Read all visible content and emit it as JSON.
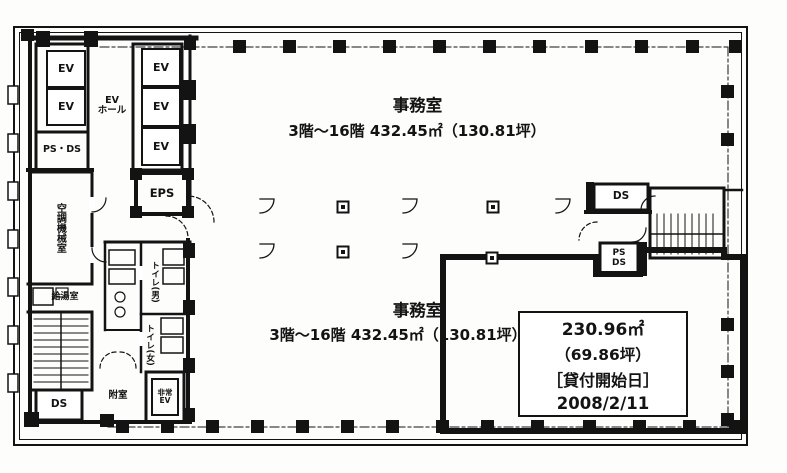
{
  "plan_type": "office-floor-plan",
  "colors": {
    "ink": "#131313",
    "paper": "#fdfdfc"
  },
  "labels": {
    "ev": "EV",
    "ev_hall": {
      "line1": "EV",
      "line2": "ホール"
    },
    "ps_ds_left": "PS・DS",
    "eps": "EPS",
    "hvac_room": "空調機械室",
    "kitchenette": "給湯室",
    "toilet_men": "トイレ(男)",
    "toilet_women": "トイレ(女)",
    "ds_lower_left": "DS",
    "vestibule": "附室",
    "emergency_ev": {
      "line1": "非常",
      "line2": "EV"
    },
    "ds_right": "DS",
    "ps_ds_right": {
      "line1": "PS",
      "line2": "DS"
    }
  },
  "offices": {
    "upper": {
      "name": "事務室",
      "detail": "3階～16階 432.45㎡（130.81坪）"
    },
    "lower": {
      "name": "事務室",
      "detail": "3階～16階 432.45㎡（130.81坪）"
    }
  },
  "tenant_box": {
    "area_m2": "230.96㎡",
    "area_tsubo": "（69.86坪）",
    "lease_start_label": "［貸付開始日］",
    "lease_start_date": "2008/2/11"
  }
}
